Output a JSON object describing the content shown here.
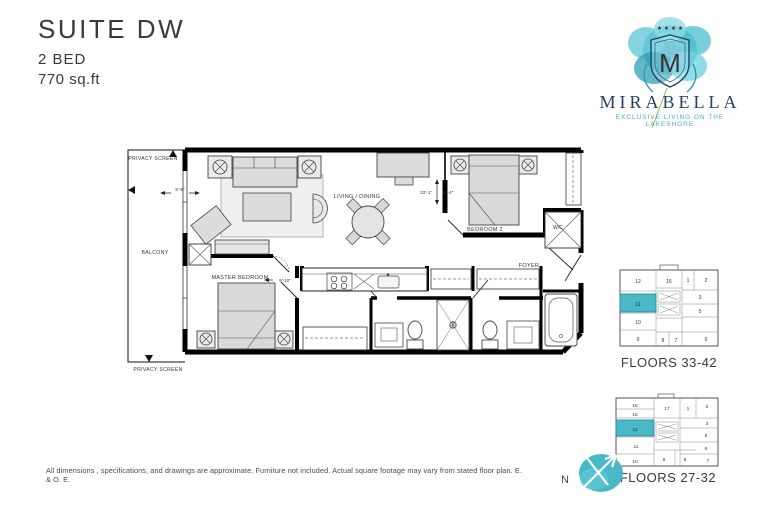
{
  "header": {
    "suite": "SUITE DW",
    "beds": "2 BED",
    "area": "770 sq.ft"
  },
  "logo": {
    "name": "MIRABELLA",
    "tagline": "EXCLUSIVE LIVING ON THE LAKESHORE",
    "monogram": "M",
    "stars": "★ ★ ★ ★"
  },
  "floorplan": {
    "labels": {
      "privacy_screen_top": "PRIVACY SCREEN",
      "privacy_screen_bottom": "PRIVACY SCREEN",
      "balcony": "BALCONY",
      "living_dining": "LIVING / DINING",
      "master_bedroom": "MASTER BEDROOM",
      "bedroom2": "BEDROOM 2",
      "foyer": "FOYER",
      "wc": "W/C"
    },
    "dimensions": {
      "balcony_door": "5'-9\"",
      "living_width": "22'-1\"",
      "living_depth": "11'-4\"",
      "kitchen": "9'-10\""
    }
  },
  "keyplans": [
    {
      "caption": "FLOORS 33-42",
      "highlighted_unit": "11",
      "units": [
        "12",
        "16",
        "1",
        "2",
        "11",
        "3",
        "10",
        "5",
        "9",
        "8",
        "7",
        "6"
      ]
    },
    {
      "caption": "FLOORS 27-32",
      "highlighted_unit": "12",
      "units": [
        "16",
        "15",
        "17",
        "1",
        "2",
        "3",
        "12",
        "11",
        "5",
        "6",
        "10",
        "9",
        "8",
        "7"
      ]
    }
  ],
  "compass": {
    "north": "N"
  },
  "colors": {
    "teal": "#49b9c8",
    "navy": "#24415f",
    "line": "#111111"
  },
  "disclaimer": "All dimensions , specifications, and drawings are approximate. Furniture not included. Actual square footage may vary from stated floor plan.  E. & O. E."
}
